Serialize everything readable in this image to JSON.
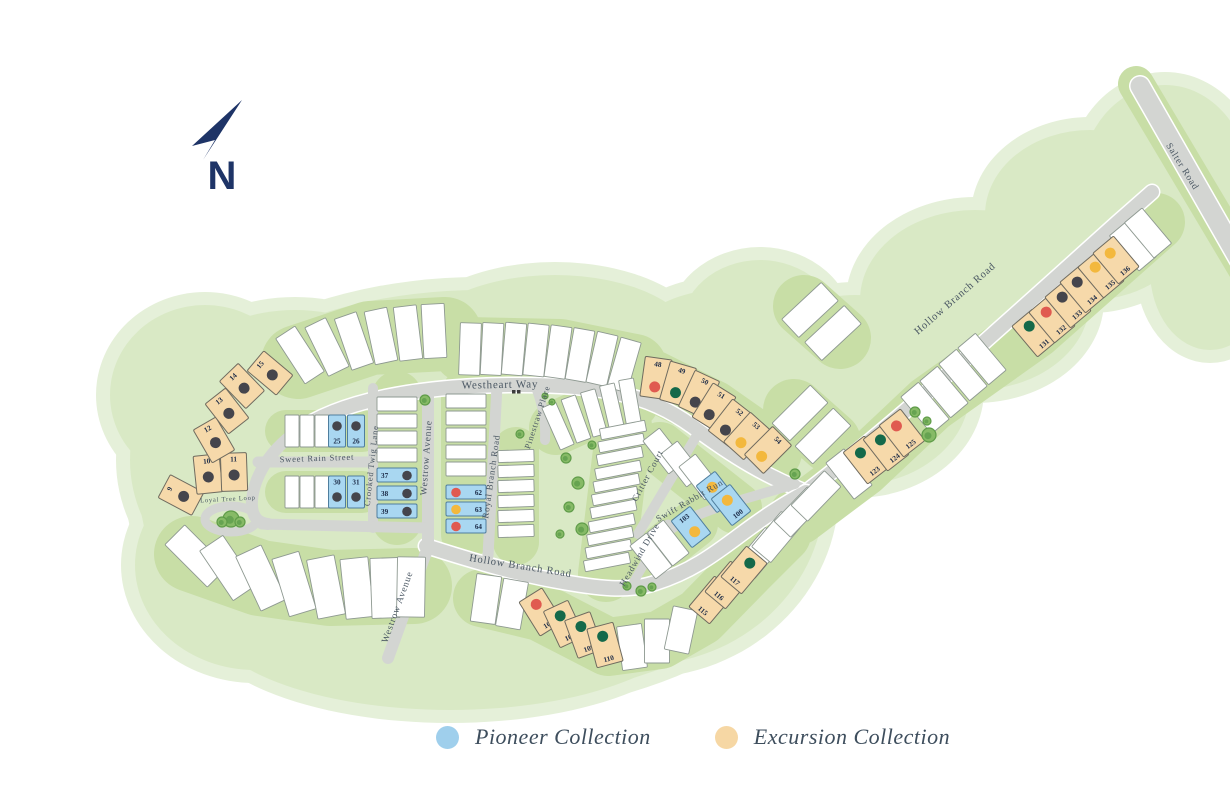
{
  "north": {
    "label": "N",
    "color": "#1e3467"
  },
  "legend": {
    "items": [
      {
        "id": "pioneer",
        "label": "Pioneer Collection",
        "color": "#9fcfec"
      },
      {
        "id": "excursion",
        "label": "Excursion Collection",
        "color": "#f6d7a4"
      }
    ]
  },
  "collections": {
    "pioneer": {
      "fill": "#a9d7f1",
      "stroke": "#4f7e9e"
    },
    "excursion": {
      "fill": "#f6d9aa",
      "stroke": "#6f6b5f"
    }
  },
  "dot_colors": {
    "dark": "#45454c",
    "red": "#e05a50",
    "yellow": "#f3b83d",
    "green": "#14694a"
  },
  "map_colors": {
    "green_fringe": "#e5f0d9",
    "green_main": "#d9e9c5",
    "block_band": "#c8dea6",
    "road": "#d3d5d2",
    "white_lot_stroke": "#8e9991",
    "street_text": "#4a5763",
    "number_text": "#1c2b47",
    "tree_fill": "#86ba66",
    "tree_stroke": "#5f9c49"
  },
  "streets": [
    {
      "name": "Westheart Way",
      "x": 500,
      "y": 388,
      "rot": -1,
      "size": 11
    },
    {
      "name": "Sweet Rain Street",
      "x": 317,
      "y": 461,
      "rot": -2,
      "size": 8.5
    },
    {
      "name": "Loyal Tree Loop",
      "x": 228,
      "y": 501,
      "rot": -3,
      "size": 6.5
    },
    {
      "name": "Crooked Twig Lane",
      "x": 374,
      "y": 466,
      "rot": -84,
      "size": 8.5
    },
    {
      "name": "Westrow Avenue",
      "x": 429,
      "y": 458,
      "rot": -86,
      "size": 9.5
    },
    {
      "name": "Westrow Avenue",
      "x": 400,
      "y": 608,
      "rot": -70,
      "size": 9.5
    },
    {
      "name": "Royal Branch Road",
      "x": 494,
      "y": 477,
      "rot": -82,
      "size": 9
    },
    {
      "name": "Pinestraw Place",
      "x": 540,
      "y": 418,
      "rot": -72,
      "size": 8.5
    },
    {
      "name": "Hollow Branch Road",
      "x": 520,
      "y": 569,
      "rot": 9,
      "size": 10.5
    },
    {
      "name": "Critter Court",
      "x": 650,
      "y": 477,
      "rot": -62,
      "size": 9
    },
    {
      "name": "Swift Rabbit Run",
      "x": 691,
      "y": 503,
      "rot": -30,
      "size": 9
    },
    {
      "name": "Headwind Drive",
      "x": 642,
      "y": 556,
      "rot": -60,
      "size": 9
    },
    {
      "name": "Hollow Branch Road",
      "x": 957,
      "y": 301,
      "rot": -41,
      "size": 10.5
    },
    {
      "name": "Salter Road",
      "x": 1180,
      "y": 168,
      "rot": 58,
      "size": 9.5
    }
  ],
  "lots": [
    {
      "n": "9",
      "c": "excursion",
      "dot": "dark",
      "x": 181,
      "y": 495,
      "r": -62,
      "w": 26,
      "h": 38,
      "np": "top",
      "dp": "center"
    },
    {
      "n": "10",
      "c": "excursion",
      "dot": "dark",
      "x": 208,
      "y": 474,
      "r": -6,
      "w": 26,
      "h": 38,
      "np": "top",
      "dp": "center"
    },
    {
      "n": "11",
      "c": "excursion",
      "dot": "dark",
      "x": 234,
      "y": 472,
      "r": -2,
      "w": 26,
      "h": 38,
      "np": "top",
      "dp": "center"
    },
    {
      "n": "12",
      "c": "excursion",
      "dot": "dark",
      "x": 214,
      "y": 440,
      "r": -30,
      "w": 26,
      "h": 38,
      "np": "top",
      "dp": "center"
    },
    {
      "n": "13",
      "c": "excursion",
      "dot": "dark",
      "x": 227,
      "y": 411,
      "r": -38,
      "w": 26,
      "h": 38,
      "np": "top",
      "dp": "center"
    },
    {
      "n": "14",
      "c": "excursion",
      "dot": "dark",
      "x": 242,
      "y": 386,
      "r": -44,
      "w": 26,
      "h": 38,
      "np": "top",
      "dp": "center"
    },
    {
      "n": "15",
      "c": "excursion",
      "dot": "dark",
      "x": 270,
      "y": 373,
      "r": -50,
      "w": 26,
      "h": 38,
      "np": "top",
      "dp": "center"
    },
    {
      "n": "25",
      "c": "pioneer",
      "dot": "dark",
      "x": 337,
      "y": 431,
      "r": 0,
      "w": 17,
      "h": 32,
      "np": "bottom",
      "dp": "top"
    },
    {
      "n": "26",
      "c": "pioneer",
      "dot": "dark",
      "x": 356,
      "y": 431,
      "r": 0,
      "w": 17,
      "h": 32,
      "np": "bottom",
      "dp": "top"
    },
    {
      "n": "30",
      "c": "pioneer",
      "dot": "dark",
      "x": 337,
      "y": 492,
      "r": 0,
      "w": 17,
      "h": 32,
      "np": "top",
      "dp": "bottom"
    },
    {
      "n": "31",
      "c": "pioneer",
      "dot": "dark",
      "x": 356,
      "y": 492,
      "r": 0,
      "w": 17,
      "h": 32,
      "np": "top",
      "dp": "bottom"
    },
    {
      "n": "37",
      "c": "pioneer",
      "dot": "dark",
      "x": 397,
      "y": 475,
      "r": 0,
      "w": 40,
      "h": 14,
      "np": "left",
      "dp": "right"
    },
    {
      "n": "38",
      "c": "pioneer",
      "dot": "dark",
      "x": 397,
      "y": 493,
      "r": 0,
      "w": 40,
      "h": 14,
      "np": "left",
      "dp": "right"
    },
    {
      "n": "39",
      "c": "pioneer",
      "dot": "dark",
      "x": 397,
      "y": 511,
      "r": 0,
      "w": 40,
      "h": 14,
      "np": "left",
      "dp": "right"
    },
    {
      "n": "62",
      "c": "pioneer",
      "dot": "red",
      "x": 466,
      "y": 492,
      "r": 0,
      "w": 40,
      "h": 14,
      "np": "right",
      "dp": "left"
    },
    {
      "n": "63",
      "c": "pioneer",
      "dot": "yellow",
      "x": 466,
      "y": 509,
      "r": 0,
      "w": 40,
      "h": 14,
      "np": "right",
      "dp": "left"
    },
    {
      "n": "64",
      "c": "pioneer",
      "dot": "red",
      "x": 466,
      "y": 526,
      "r": 0,
      "w": 40,
      "h": 14,
      "np": "right",
      "dp": "left"
    },
    {
      "n": "48",
      "c": "excursion",
      "dot": "red",
      "x": 656,
      "y": 378,
      "r": 8,
      "w": 27,
      "h": 40,
      "np": "top",
      "dp": "bottom"
    },
    {
      "n": "49",
      "c": "excursion",
      "dot": "green",
      "x": 678,
      "y": 384,
      "r": 16,
      "w": 27,
      "h": 40,
      "np": "top",
      "dp": "bottom"
    },
    {
      "n": "50",
      "c": "excursion",
      "dot": "dark",
      "x": 699,
      "y": 394,
      "r": 25,
      "w": 27,
      "h": 40,
      "np": "top",
      "dp": "bottom"
    },
    {
      "n": "51",
      "c": "excursion",
      "dot": "dark",
      "x": 714,
      "y": 407,
      "r": 32,
      "w": 27,
      "h": 40,
      "np": "top",
      "dp": "bottom"
    },
    {
      "n": "52",
      "c": "excursion",
      "dot": "dark",
      "x": 731,
      "y": 423,
      "r": 38,
      "w": 27,
      "h": 40,
      "np": "top",
      "dp": "bottom"
    },
    {
      "n": "53",
      "c": "excursion",
      "dot": "yellow",
      "x": 747,
      "y": 436,
      "r": 42,
      "w": 27,
      "h": 40,
      "np": "top",
      "dp": "bottom"
    },
    {
      "n": "54",
      "c": "excursion",
      "dot": "yellow",
      "x": 768,
      "y": 450,
      "r": 45,
      "w": 27,
      "h": 40,
      "np": "top",
      "dp": "bottom"
    },
    {
      "n": "99",
      "c": "pioneer",
      "dot": "yellow",
      "x": 716,
      "y": 492,
      "r": -38,
      "w": 24,
      "h": 34,
      "np": "bottom",
      "dp": "top"
    },
    {
      "n": "100",
      "c": "pioneer",
      "dot": "yellow",
      "x": 731,
      "y": 505,
      "r": -38,
      "w": 24,
      "h": 34,
      "np": "bottom",
      "dp": "top"
    },
    {
      "n": "103",
      "c": "pioneer",
      "dot": "yellow",
      "x": 691,
      "y": 527,
      "r": -38,
      "w": 24,
      "h": 34,
      "np": "top",
      "dp": "bottom"
    },
    {
      "n": "107",
      "c": "excursion",
      "dot": "red",
      "x": 541,
      "y": 612,
      "r": -32,
      "w": 27,
      "h": 40,
      "np": "bottom",
      "dp": "top"
    },
    {
      "n": "108",
      "c": "excursion",
      "dot": "green",
      "x": 564,
      "y": 624,
      "r": -25,
      "w": 27,
      "h": 40,
      "np": "bottom",
      "dp": "top"
    },
    {
      "n": "109",
      "c": "excursion",
      "dot": "green",
      "x": 584,
      "y": 635,
      "r": -20,
      "w": 27,
      "h": 40,
      "np": "bottom",
      "dp": "top"
    },
    {
      "n": "110",
      "c": "excursion",
      "dot": "green",
      "x": 605,
      "y": 645,
      "r": -15,
      "w": 27,
      "h": 40,
      "np": "bottom",
      "dp": "top"
    },
    {
      "n": "115",
      "c": "excursion",
      "dot": "red",
      "x": 712,
      "y": 600,
      "r": 40,
      "w": 27,
      "h": 40,
      "np": "bottom",
      "dp": "top"
    },
    {
      "n": "116",
      "c": "excursion",
      "dot": "green",
      "x": 728,
      "y": 585,
      "r": 40,
      "w": 27,
      "h": 40,
      "np": "bottom",
      "dp": "top"
    },
    {
      "n": "117",
      "c": "excursion",
      "dot": "green",
      "x": 744,
      "y": 570,
      "r": 40,
      "w": 27,
      "h": 40,
      "np": "bottom",
      "dp": "top"
    },
    {
      "n": "123",
      "c": "excursion",
      "dot": "green",
      "x": 866,
      "y": 460,
      "r": -38,
      "w": 27,
      "h": 40,
      "np": "bottom",
      "dp": "top"
    },
    {
      "n": "124",
      "c": "excursion",
      "dot": "green",
      "x": 886,
      "y": 447,
      "r": -38,
      "w": 27,
      "h": 40,
      "np": "bottom",
      "dp": "top"
    },
    {
      "n": "125",
      "c": "excursion",
      "dot": "red",
      "x": 902,
      "y": 433,
      "r": -38,
      "w": 27,
      "h": 40,
      "np": "bottom",
      "dp": "top"
    },
    {
      "n": "131",
      "c": "excursion",
      "dot": "green",
      "x": 1035,
      "y": 333,
      "r": -40,
      "w": 27,
      "h": 40,
      "np": "bottom",
      "dp": "top"
    },
    {
      "n": "132",
      "c": "excursion",
      "dot": "red",
      "x": 1052,
      "y": 319,
      "r": -40,
      "w": 27,
      "h": 40,
      "np": "bottom",
      "dp": "top"
    },
    {
      "n": "133",
      "c": "excursion",
      "dot": "dark",
      "x": 1068,
      "y": 304,
      "r": -40,
      "w": 27,
      "h": 40,
      "np": "bottom",
      "dp": "top"
    },
    {
      "n": "134",
      "c": "excursion",
      "dot": "dark",
      "x": 1083,
      "y": 289,
      "r": -40,
      "w": 27,
      "h": 40,
      "np": "bottom",
      "dp": "top"
    },
    {
      "n": "135",
      "c": "excursion",
      "dot": "yellow",
      "x": 1101,
      "y": 274,
      "r": -40,
      "w": 27,
      "h": 40,
      "np": "bottom",
      "dp": "top"
    },
    {
      "n": "136",
      "c": "excursion",
      "dot": "yellow",
      "x": 1116,
      "y": 260,
      "r": -40,
      "w": 27,
      "h": 40,
      "np": "bottom",
      "dp": "top"
    }
  ]
}
